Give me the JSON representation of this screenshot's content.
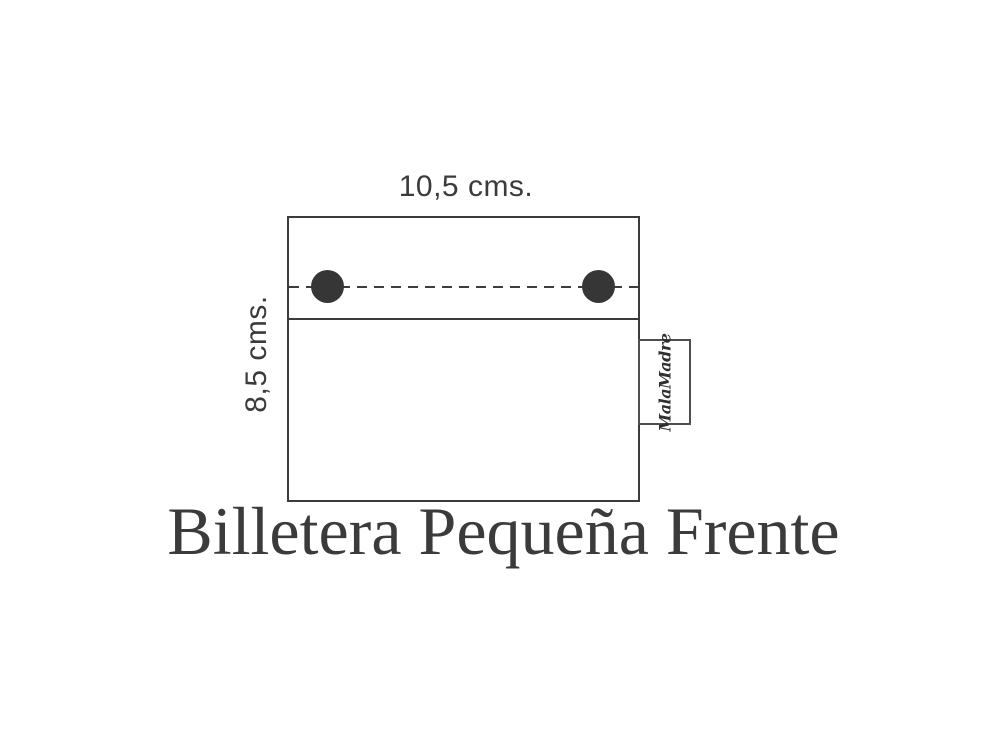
{
  "title": {
    "text": "Billetera Pequeña Frente"
  },
  "diagram": {
    "width_label": "10,5 cms.",
    "height_label": "8,5 cms.",
    "brand_label": "MalaMadre",
    "snap_count": 2
  },
  "colors": {
    "background": "#ffffff",
    "outline": "#3b3b3b",
    "snap_dot": "#363636",
    "text": "#3b3b3b",
    "tab_border": "#4f4f4f"
  }
}
